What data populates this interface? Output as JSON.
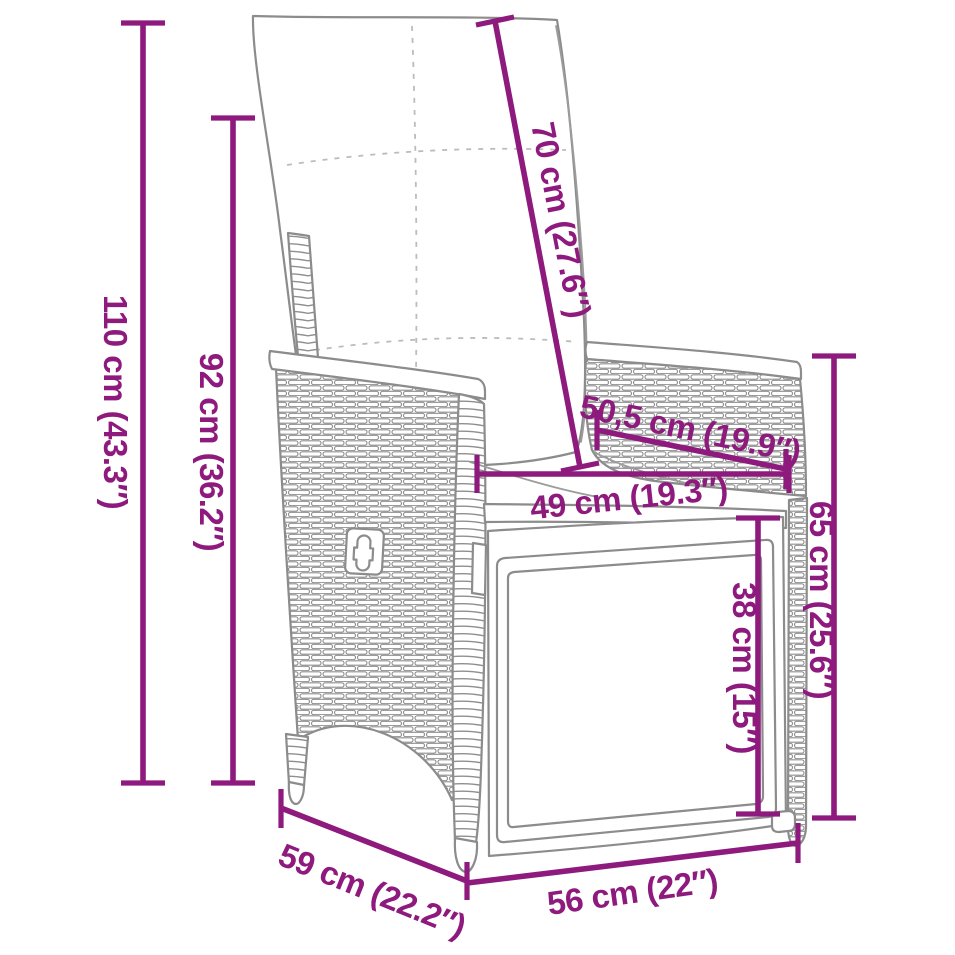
{
  "diagram": {
    "type": "product-dimension-diagram",
    "subject": "reclining wicker garden chair with cushions and pull-out footrest",
    "accent_color": "#8e1a7d",
    "artwork_color": "#8c8c8c",
    "background_color": "#ffffff",
    "dimensions": [
      {
        "id": "total-height",
        "label": "110 cm (43.3″)"
      },
      {
        "id": "back-height",
        "label": "92 cm (36.2″)"
      },
      {
        "id": "backrest-length",
        "label": "70 cm (27.6″)"
      },
      {
        "id": "armrest-length",
        "label": "50,5 cm (19.9″)"
      },
      {
        "id": "seat-width",
        "label": "49 cm (19.3″)"
      },
      {
        "id": "armrest-height",
        "label": "65 cm (25.6″)"
      },
      {
        "id": "footrest-height",
        "label": "38 cm (15″)"
      },
      {
        "id": "seat-depth",
        "label": "59 cm (22.2″)"
      },
      {
        "id": "front-width",
        "label": "56 cm (22″)"
      }
    ]
  }
}
